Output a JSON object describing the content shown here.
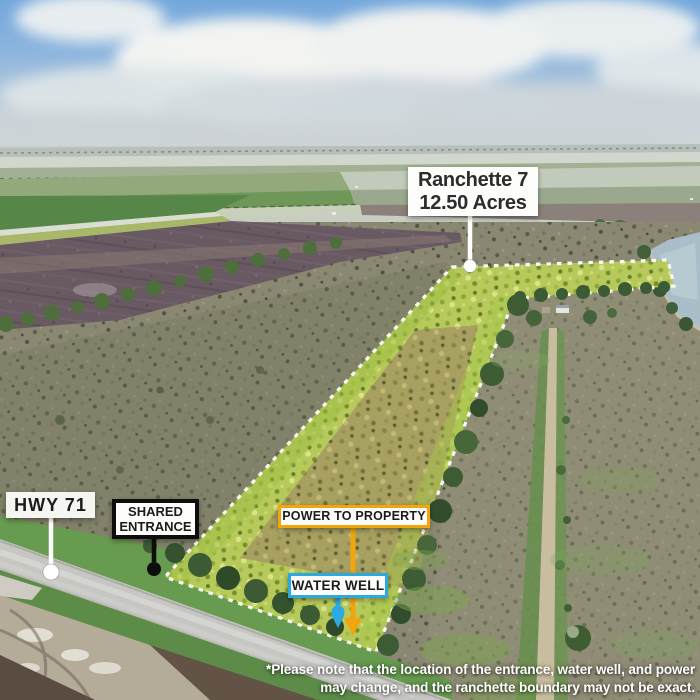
{
  "annotations": {
    "property_label": {
      "line1": "Ranchette 7",
      "line2": "12.50 Acres"
    },
    "highway_label": "HWY 71",
    "entrance_label": {
      "line1": "SHARED",
      "line2": "ENTRANCE"
    },
    "power_label": "POWER TO PROPERTY",
    "water_label": "WATER WELL",
    "disclaimer_line1": "*Please note that the location of the entrance, water well, and power",
    "disclaimer_line2": "may change, and the ranchette boundary may not be exact."
  },
  "colors": {
    "power_accent": "#F2A50C",
    "water_accent": "#2BA9E0",
    "entrance_accent": "#0D0D0D",
    "boundary_dash": "#FFFFFF",
    "label_bg": "#FDFDFB",
    "label_text": "#1C1C1C",
    "disclaimer_text": "#FFFFFF"
  }
}
